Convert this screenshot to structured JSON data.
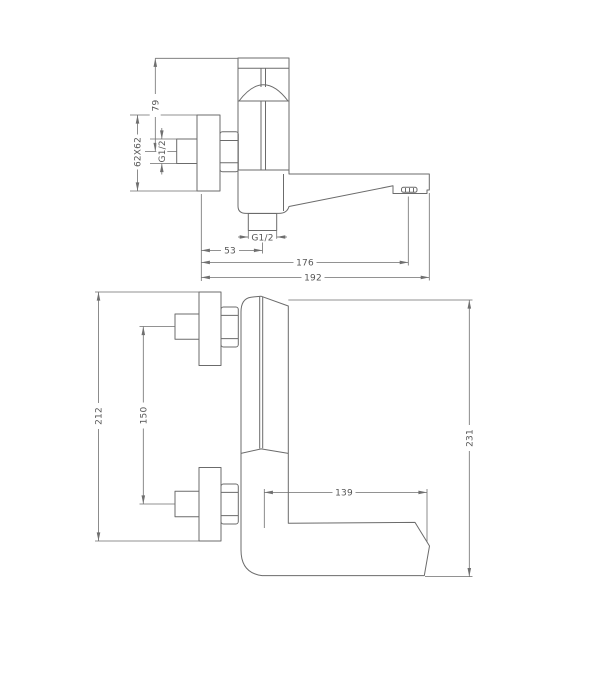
{
  "drawing": {
    "background": "#ffffff",
    "line_color": "#6b6b6b",
    "text_color": "#555555",
    "side_view": {
      "name": "side profile view of wall-mounted bath mixer",
      "dims": {
        "handle_height": "79",
        "wall_plate_size": "62X62",
        "inlet_thread": "G1/2",
        "outlet_thread": "G1/2",
        "outlet_offset": "53",
        "aerator_reach": "176",
        "spout_reach": "192"
      }
    },
    "front_view": {
      "name": "front elevation view of wall-mounted bath mixer",
      "dims": {
        "plate_span": "212",
        "inlet_spacing": "150",
        "spout_length": "139",
        "overall_height": "231"
      }
    }
  }
}
